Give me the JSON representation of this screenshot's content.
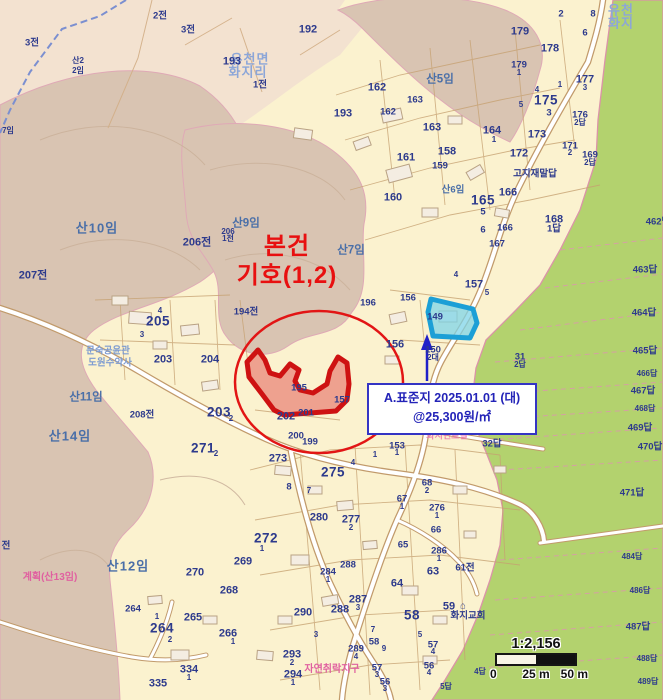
{
  "annotation": {
    "line1": "본건",
    "line2": "기호(1,2)"
  },
  "callout": {
    "line1": "A.표준지 2025.01.01 (대)",
    "line2": "@25,300원/㎡"
  },
  "scalebar": {
    "ratio": "1:2,156",
    "tick0": "0",
    "tick1": "25 m",
    "tick2": "50 m"
  },
  "colors": {
    "cream": "#FBF2CF",
    "peach": "#F3E2D0",
    "forest_tan": "#D9C4B2",
    "paddy_green": "#B3D26E",
    "parcel_navy": "#2D3A8C",
    "hill_blue": "#4A6FA8",
    "place_blue": "#8CA6D8",
    "zone_pink": "#E060A0",
    "subject_red": "#CE1212",
    "standard_cyan": "#1C9FD6",
    "callout_blue": "#3434C4"
  },
  "map": {
    "labels": [
      {
        "t": "2전",
        "x": 160,
        "y": 16,
        "c": "sm"
      },
      {
        "t": "3전",
        "x": 188,
        "y": 30,
        "c": "sm"
      },
      {
        "t": "3전",
        "x": 32,
        "y": 43,
        "c": "sm"
      },
      {
        "t": "산2",
        "x": 78,
        "y": 61,
        "c": "xs"
      },
      {
        "t": "2임",
        "x": 78,
        "y": 71,
        "c": "xs"
      },
      {
        "t": "유천면",
        "x": 250,
        "y": 59,
        "c": "place"
      },
      {
        "t": "화지리",
        "x": 248,
        "y": 72,
        "c": "place"
      },
      {
        "t": "193",
        "x": 232,
        "y": 62,
        "c": "md"
      },
      {
        "t": "1전",
        "x": 260,
        "y": 85,
        "c": "sm"
      },
      {
        "t": "192",
        "x": 308,
        "y": 30,
        "c": "md"
      },
      {
        "t": "유천",
        "x": 621,
        "y": 10,
        "c": "place"
      },
      {
        "t": "화지",
        "x": 621,
        "y": 23,
        "c": "place"
      },
      {
        "t": "7임",
        "x": 8,
        "y": 131,
        "c": "xs"
      },
      {
        "t": "산10임",
        "x": 97,
        "y": 228,
        "c": "mtn-lg"
      },
      {
        "t": "산9임",
        "x": 246,
        "y": 224,
        "c": "mtn"
      },
      {
        "t": "산7임",
        "x": 351,
        "y": 251,
        "c": "mtn"
      },
      {
        "t": "산5임",
        "x": 440,
        "y": 80,
        "c": "mtn"
      },
      {
        "t": "산6임",
        "x": 453,
        "y": 190,
        "c": "mtn-sm"
      },
      {
        "t": "산11임",
        "x": 86,
        "y": 398,
        "c": "mtn"
      },
      {
        "t": "산14임",
        "x": 70,
        "y": 436,
        "c": "mtn-lg"
      },
      {
        "t": "산12임",
        "x": 128,
        "y": 566,
        "c": "mtn-lg"
      },
      {
        "t": "207전",
        "x": 33,
        "y": 276,
        "c": "md"
      },
      {
        "t": "206전",
        "x": 197,
        "y": 243,
        "c": "md"
      },
      {
        "t": "206",
        "x": 228,
        "y": 232,
        "c": "xs"
      },
      {
        "t": "1전",
        "x": 228,
        "y": 239,
        "c": "xs"
      },
      {
        "t": "208전",
        "x": 142,
        "y": 415,
        "c": "sm"
      },
      {
        "t": "전",
        "x": 6,
        "y": 546,
        "c": "sm"
      },
      {
        "t": "2",
        "x": 561,
        "y": 14,
        "c": "sm"
      },
      {
        "t": "8",
        "x": 593,
        "y": 14,
        "c": "sm"
      },
      {
        "t": "179",
        "x": 520,
        "y": 32,
        "c": "md"
      },
      {
        "t": "6",
        "x": 585,
        "y": 33,
        "c": "sm"
      },
      {
        "t": "178",
        "x": 550,
        "y": 49,
        "c": "md"
      },
      {
        "t": "179",
        "x": 519,
        "y": 65,
        "c": "sm"
      },
      {
        "t": "1",
        "x": 519,
        "y": 73,
        "c": "xs"
      },
      {
        "t": "177",
        "x": 585,
        "y": 80,
        "c": "md"
      },
      {
        "t": "3",
        "x": 585,
        "y": 88,
        "c": "xs"
      },
      {
        "t": "1",
        "x": 560,
        "y": 85,
        "c": "xs"
      },
      {
        "t": "175",
        "x": 546,
        "y": 100,
        "c": "lg"
      },
      {
        "t": "3",
        "x": 549,
        "y": 113,
        "c": "sm"
      },
      {
        "t": "4",
        "x": 537,
        "y": 90,
        "c": "xs"
      },
      {
        "t": "5",
        "x": 521,
        "y": 105,
        "c": "xs"
      },
      {
        "t": "176",
        "x": 580,
        "y": 115,
        "c": "sm"
      },
      {
        "t": "2답",
        "x": 580,
        "y": 123,
        "c": "xs"
      },
      {
        "t": "173",
        "x": 537,
        "y": 135,
        "c": "md"
      },
      {
        "t": "171",
        "x": 570,
        "y": 146,
        "c": "sm"
      },
      {
        "t": "2",
        "x": 570,
        "y": 153,
        "c": "xs"
      },
      {
        "t": "169",
        "x": 590,
        "y": 155,
        "c": "sm"
      },
      {
        "t": "2답",
        "x": 590,
        "y": 163,
        "c": "xs"
      },
      {
        "t": "172",
        "x": 519,
        "y": 154,
        "c": "md"
      },
      {
        "t": "고지재말답",
        "x": 535,
        "y": 174,
        "c": "sm"
      },
      {
        "t": "158",
        "x": 447,
        "y": 152,
        "c": "md"
      },
      {
        "t": "159",
        "x": 440,
        "y": 166,
        "c": "sm"
      },
      {
        "t": "161",
        "x": 406,
        "y": 158,
        "c": "md"
      },
      {
        "t": "162",
        "x": 377,
        "y": 88,
        "c": "md"
      },
      {
        "t": "162",
        "x": 388,
        "y": 112,
        "c": "sm"
      },
      {
        "t": "163",
        "x": 415,
        "y": 100,
        "c": "sm"
      },
      {
        "t": "163",
        "x": 432,
        "y": 128,
        "c": "md"
      },
      {
        "t": "164",
        "x": 492,
        "y": 131,
        "c": "md"
      },
      {
        "t": "1",
        "x": 494,
        "y": 140,
        "c": "xs"
      },
      {
        "t": "193",
        "x": 343,
        "y": 114,
        "c": "md"
      },
      {
        "t": "160",
        "x": 393,
        "y": 198,
        "c": "md"
      },
      {
        "t": "165",
        "x": 483,
        "y": 200,
        "c": "lg"
      },
      {
        "t": "5",
        "x": 483,
        "y": 212,
        "c": "sm"
      },
      {
        "t": "166",
        "x": 508,
        "y": 193,
        "c": "md"
      },
      {
        "t": "166",
        "x": 505,
        "y": 228,
        "c": "sm"
      },
      {
        "t": "6",
        "x": 483,
        "y": 230,
        "c": "sm"
      },
      {
        "t": "167",
        "x": 497,
        "y": 244,
        "c": "sm"
      },
      {
        "t": "168",
        "x": 554,
        "y": 220,
        "c": "md"
      },
      {
        "t": "1답",
        "x": 554,
        "y": 229,
        "c": "sm"
      },
      {
        "t": "157",
        "x": 474,
        "y": 285,
        "c": "md"
      },
      {
        "t": "5",
        "x": 487,
        "y": 293,
        "c": "xs"
      },
      {
        "t": "4",
        "x": 456,
        "y": 275,
        "c": "xs"
      },
      {
        "t": "196",
        "x": 368,
        "y": 303,
        "c": "sm"
      },
      {
        "t": "156",
        "x": 408,
        "y": 298,
        "c": "sm"
      },
      {
        "t": "156",
        "x": 395,
        "y": 345,
        "c": "md"
      },
      {
        "t": "149",
        "x": 435,
        "y": 317,
        "c": "sm"
      },
      {
        "t": "150",
        "x": 433,
        "y": 350,
        "c": "sm"
      },
      {
        "t": "2대",
        "x": 433,
        "y": 358,
        "c": "xs"
      },
      {
        "t": "153",
        "x": 397,
        "y": 446,
        "c": "sm"
      },
      {
        "t": "1",
        "x": 397,
        "y": 453,
        "c": "xs"
      },
      {
        "t": "157",
        "x": 342,
        "y": 400,
        "c": "sm"
      },
      {
        "t": "194전",
        "x": 246,
        "y": 312,
        "c": "sm"
      },
      {
        "t": "195",
        "x": 299,
        "y": 388,
        "c": "sm"
      },
      {
        "t": "202",
        "x": 286,
        "y": 417,
        "c": "md"
      },
      {
        "t": "201",
        "x": 306,
        "y": 413,
        "c": "sm"
      },
      {
        "t": "204",
        "x": 210,
        "y": 360,
        "c": "md"
      },
      {
        "t": "203",
        "x": 163,
        "y": 360,
        "c": "md"
      },
      {
        "t": "205",
        "x": 158,
        "y": 321,
        "c": "lg"
      },
      {
        "t": "4",
        "x": 160,
        "y": 311,
        "c": "xs"
      },
      {
        "t": "3",
        "x": 142,
        "y": 335,
        "c": "xs"
      },
      {
        "t": "문숙공윤관",
        "x": 108,
        "y": 351,
        "c": "place-sm"
      },
      {
        "t": "도원수약사",
        "x": 110,
        "y": 363,
        "c": "place-sm"
      },
      {
        "t": "203",
        "x": 219,
        "y": 412,
        "c": "lg"
      },
      {
        "t": "2",
        "x": 231,
        "y": 419,
        "c": "xs"
      },
      {
        "t": "271",
        "x": 203,
        "y": 448,
        "c": "lg"
      },
      {
        "t": "2",
        "x": 216,
        "y": 454,
        "c": "xs"
      },
      {
        "t": "계획(산13임)",
        "x": 50,
        "y": 578,
        "c": "pink"
      },
      {
        "t": "화지현로길",
        "x": 447,
        "y": 436,
        "c": "pink-sm"
      },
      {
        "t": "31",
        "x": 520,
        "y": 357,
        "c": "sm"
      },
      {
        "t": "2답",
        "x": 520,
        "y": 365,
        "c": "xs"
      },
      {
        "t": "32답",
        "x": 492,
        "y": 444,
        "c": "sm"
      },
      {
        "t": "462답",
        "x": 658,
        "y": 222,
        "c": "sm"
      },
      {
        "t": "463답",
        "x": 645,
        "y": 270,
        "c": "sm"
      },
      {
        "t": "464답",
        "x": 644,
        "y": 313,
        "c": "sm"
      },
      {
        "t": "465답",
        "x": 645,
        "y": 351,
        "c": "sm"
      },
      {
        "t": "466답",
        "x": 647,
        "y": 374,
        "c": "xs"
      },
      {
        "t": "467답",
        "x": 643,
        "y": 391,
        "c": "sm"
      },
      {
        "t": "468답",
        "x": 645,
        "y": 409,
        "c": "xs"
      },
      {
        "t": "469답",
        "x": 640,
        "y": 428,
        "c": "sm"
      },
      {
        "t": "470답",
        "x": 650,
        "y": 447,
        "c": "sm"
      },
      {
        "t": "471답",
        "x": 632,
        "y": 493,
        "c": "sm"
      },
      {
        "t": "484답",
        "x": 632,
        "y": 557,
        "c": "xs"
      },
      {
        "t": "486답",
        "x": 640,
        "y": 591,
        "c": "xs"
      },
      {
        "t": "487답",
        "x": 638,
        "y": 627,
        "c": "sm"
      },
      {
        "t": "488답",
        "x": 647,
        "y": 659,
        "c": "xs"
      },
      {
        "t": "489답",
        "x": 648,
        "y": 682,
        "c": "xs"
      },
      {
        "t": "4답",
        "x": 480,
        "y": 672,
        "c": "xs"
      },
      {
        "t": "5답",
        "x": 446,
        "y": 687,
        "c": "xs"
      },
      {
        "t": "199",
        "x": 310,
        "y": 442,
        "c": "sm"
      },
      {
        "t": "200",
        "x": 296,
        "y": 436,
        "c": "sm"
      },
      {
        "t": "273",
        "x": 278,
        "y": 459,
        "c": "md"
      },
      {
        "t": "275",
        "x": 333,
        "y": 472,
        "c": "lg"
      },
      {
        "t": "4",
        "x": 353,
        "y": 463,
        "c": "xs"
      },
      {
        "t": "8",
        "x": 289,
        "y": 487,
        "c": "sm"
      },
      {
        "t": "7",
        "x": 309,
        "y": 491,
        "c": "xs"
      },
      {
        "t": "1",
        "x": 375,
        "y": 455,
        "c": "xs"
      },
      {
        "t": "280",
        "x": 319,
        "y": 518,
        "c": "md"
      },
      {
        "t": "277",
        "x": 351,
        "y": 520,
        "c": "md"
      },
      {
        "t": "2",
        "x": 351,
        "y": 528,
        "c": "xs"
      },
      {
        "t": "276",
        "x": 437,
        "y": 508,
        "c": "sm"
      },
      {
        "t": "1",
        "x": 437,
        "y": 516,
        "c": "xs"
      },
      {
        "t": "286",
        "x": 439,
        "y": 551,
        "c": "sm"
      },
      {
        "t": "1",
        "x": 439,
        "y": 559,
        "c": "xs"
      },
      {
        "t": "68",
        "x": 427,
        "y": 483,
        "c": "sm"
      },
      {
        "t": "2",
        "x": 427,
        "y": 491,
        "c": "xs"
      },
      {
        "t": "67",
        "x": 402,
        "y": 499,
        "c": "sm"
      },
      {
        "t": "1",
        "x": 402,
        "y": 507,
        "c": "xs"
      },
      {
        "t": "66",
        "x": 436,
        "y": 530,
        "c": "sm"
      },
      {
        "t": "65",
        "x": 403,
        "y": 545,
        "c": "sm"
      },
      {
        "t": "272",
        "x": 266,
        "y": 538,
        "c": "lg"
      },
      {
        "t": "1",
        "x": 262,
        "y": 549,
        "c": "xs"
      },
      {
        "t": "269",
        "x": 243,
        "y": 562,
        "c": "md"
      },
      {
        "t": "270",
        "x": 195,
        "y": 573,
        "c": "md"
      },
      {
        "t": "268",
        "x": 229,
        "y": 591,
        "c": "md"
      },
      {
        "t": "264",
        "x": 133,
        "y": 609,
        "c": "sm"
      },
      {
        "t": "1",
        "x": 157,
        "y": 617,
        "c": "xs"
      },
      {
        "t": "264",
        "x": 162,
        "y": 628,
        "c": "lg"
      },
      {
        "t": "2",
        "x": 170,
        "y": 640,
        "c": "xs"
      },
      {
        "t": "265",
        "x": 193,
        "y": 618,
        "c": "md"
      },
      {
        "t": "266",
        "x": 228,
        "y": 634,
        "c": "md"
      },
      {
        "t": "1",
        "x": 233,
        "y": 642,
        "c": "xs"
      },
      {
        "t": "334",
        "x": 189,
        "y": 670,
        "c": "md"
      },
      {
        "t": "1",
        "x": 189,
        "y": 678,
        "c": "xs"
      },
      {
        "t": "335",
        "x": 158,
        "y": 684,
        "c": "md"
      },
      {
        "t": "284",
        "x": 328,
        "y": 572,
        "c": "sm"
      },
      {
        "t": "1",
        "x": 328,
        "y": 580,
        "c": "xs"
      },
      {
        "t": "288",
        "x": 348,
        "y": 565,
        "c": "sm"
      },
      {
        "t": "288",
        "x": 340,
        "y": 610,
        "c": "md"
      },
      {
        "t": "287",
        "x": 358,
        "y": 600,
        "c": "md"
      },
      {
        "t": "3",
        "x": 358,
        "y": 608,
        "c": "xs"
      },
      {
        "t": "290",
        "x": 303,
        "y": 613,
        "c": "md"
      },
      {
        "t": "293",
        "x": 292,
        "y": 655,
        "c": "md"
      },
      {
        "t": "2",
        "x": 292,
        "y": 663,
        "c": "xs"
      },
      {
        "t": "294",
        "x": 293,
        "y": 675,
        "c": "md"
      },
      {
        "t": "1",
        "x": 293,
        "y": 683,
        "c": "xs"
      },
      {
        "t": "3",
        "x": 316,
        "y": 635,
        "c": "xs"
      },
      {
        "t": "63",
        "x": 433,
        "y": 572,
        "c": "md"
      },
      {
        "t": "64",
        "x": 397,
        "y": 584,
        "c": "md"
      },
      {
        "t": "61전",
        "x": 465,
        "y": 568,
        "c": "sm"
      },
      {
        "t": "58",
        "x": 412,
        "y": 615,
        "c": "lg"
      },
      {
        "t": "59",
        "x": 449,
        "y": 607,
        "c": "md"
      },
      {
        "t": "⌂",
        "x": 463,
        "y": 606,
        "c": "sm"
      },
      {
        "t": "화지교회",
        "x": 468,
        "y": 616,
        "c": "sm"
      },
      {
        "t": "58",
        "x": 374,
        "y": 642,
        "c": "sm"
      },
      {
        "t": "7",
        "x": 373,
        "y": 630,
        "c": "xs"
      },
      {
        "t": "5",
        "x": 420,
        "y": 635,
        "c": "xs"
      },
      {
        "t": "9",
        "x": 384,
        "y": 649,
        "c": "xs"
      },
      {
        "t": "289",
        "x": 356,
        "y": 649,
        "c": "sm"
      },
      {
        "t": "4",
        "x": 356,
        "y": 657,
        "c": "xs"
      },
      {
        "t": "57",
        "x": 433,
        "y": 645,
        "c": "sm"
      },
      {
        "t": "4",
        "x": 433,
        "y": 652,
        "c": "xs"
      },
      {
        "t": "56",
        "x": 429,
        "y": 666,
        "c": "sm"
      },
      {
        "t": "4",
        "x": 429,
        "y": 673,
        "c": "xs"
      },
      {
        "t": "57",
        "x": 377,
        "y": 668,
        "c": "sm"
      },
      {
        "t": "3",
        "x": 377,
        "y": 675,
        "c": "xs"
      },
      {
        "t": "56",
        "x": 385,
        "y": 682,
        "c": "sm"
      },
      {
        "t": "3",
        "x": 385,
        "y": 689,
        "c": "xs"
      },
      {
        "t": "자연취락지구",
        "x": 332,
        "y": 670,
        "c": "pink"
      }
    ]
  }
}
